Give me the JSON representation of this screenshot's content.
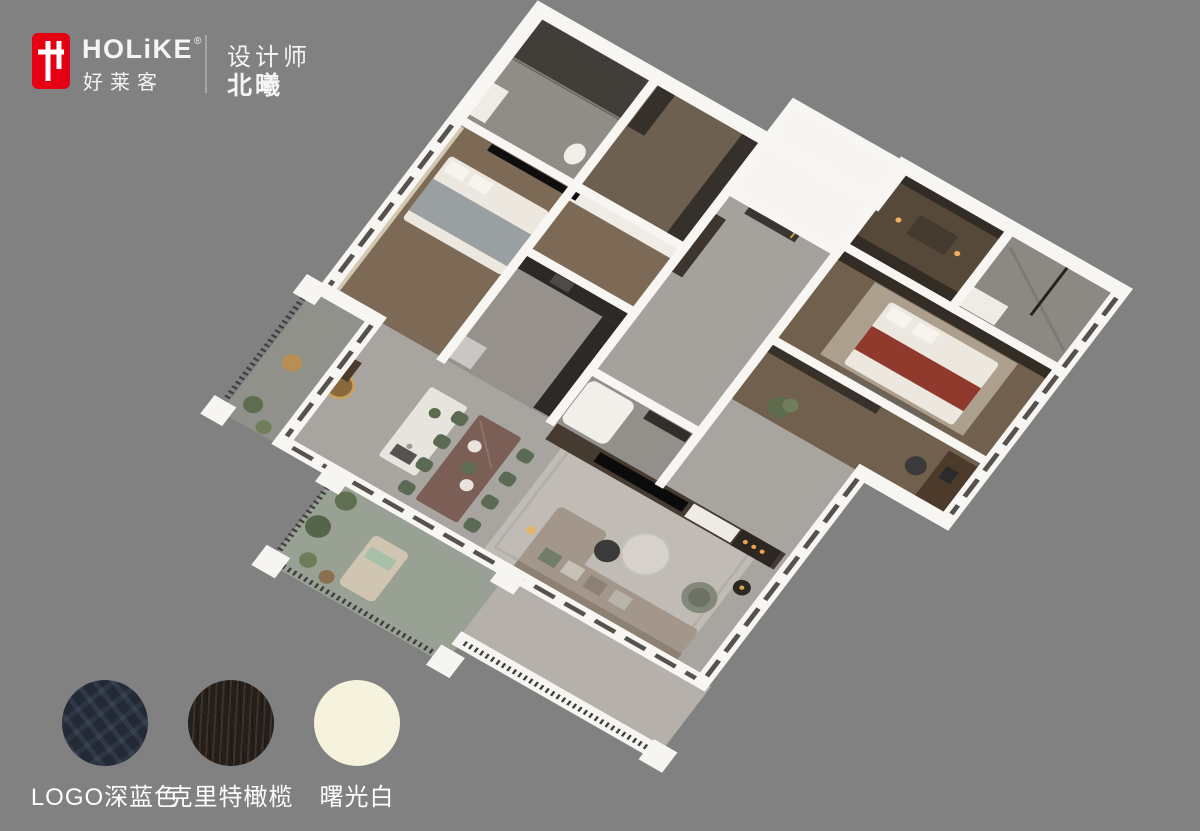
{
  "background_color": "#818181",
  "brand": {
    "latin": "HOLiKE",
    "reg": "®",
    "chinese": "好莱客",
    "logo_color": "#e50113",
    "logo_glyph": "holike-wardrobe-monogram"
  },
  "designer": {
    "role": "设计师",
    "name": "北曦"
  },
  "swatches": {
    "items": [
      {
        "label": "LOGO深蓝色",
        "color": "#232a35",
        "finish": "navy geometric pattern"
      },
      {
        "label": "克里特橄榄",
        "color": "#241f1b",
        "finish": "dark olive wood grain"
      },
      {
        "label": "曙光白",
        "color": "#f5f2dd",
        "finish": "solid cream"
      }
    ]
  },
  "floorplan": {
    "type": "isometric-3d-apartment-render",
    "rooms": [
      "entry hall",
      "kitchen",
      "kitchen island",
      "dining area",
      "living room",
      "tv media wall",
      "study",
      "master bedroom",
      "second bedroom",
      "walk-in closet",
      "shower bathroom",
      "ensuite bathroom",
      "guest bathroom",
      "left balcony",
      "planted lounge balcony",
      "glazed south balcony"
    ],
    "palette": {
      "wall_white": "#f8f6f2",
      "wood_floor": "#7d6a56",
      "gray_tile": "#a5a19c",
      "rug_gray": "#c0bcb5",
      "sofa_taupe": "#a3968a",
      "chair_green": "#5a6a55",
      "bed_throw_red": "#8f3a2c",
      "dark_wardrobe": "#332c24"
    }
  }
}
